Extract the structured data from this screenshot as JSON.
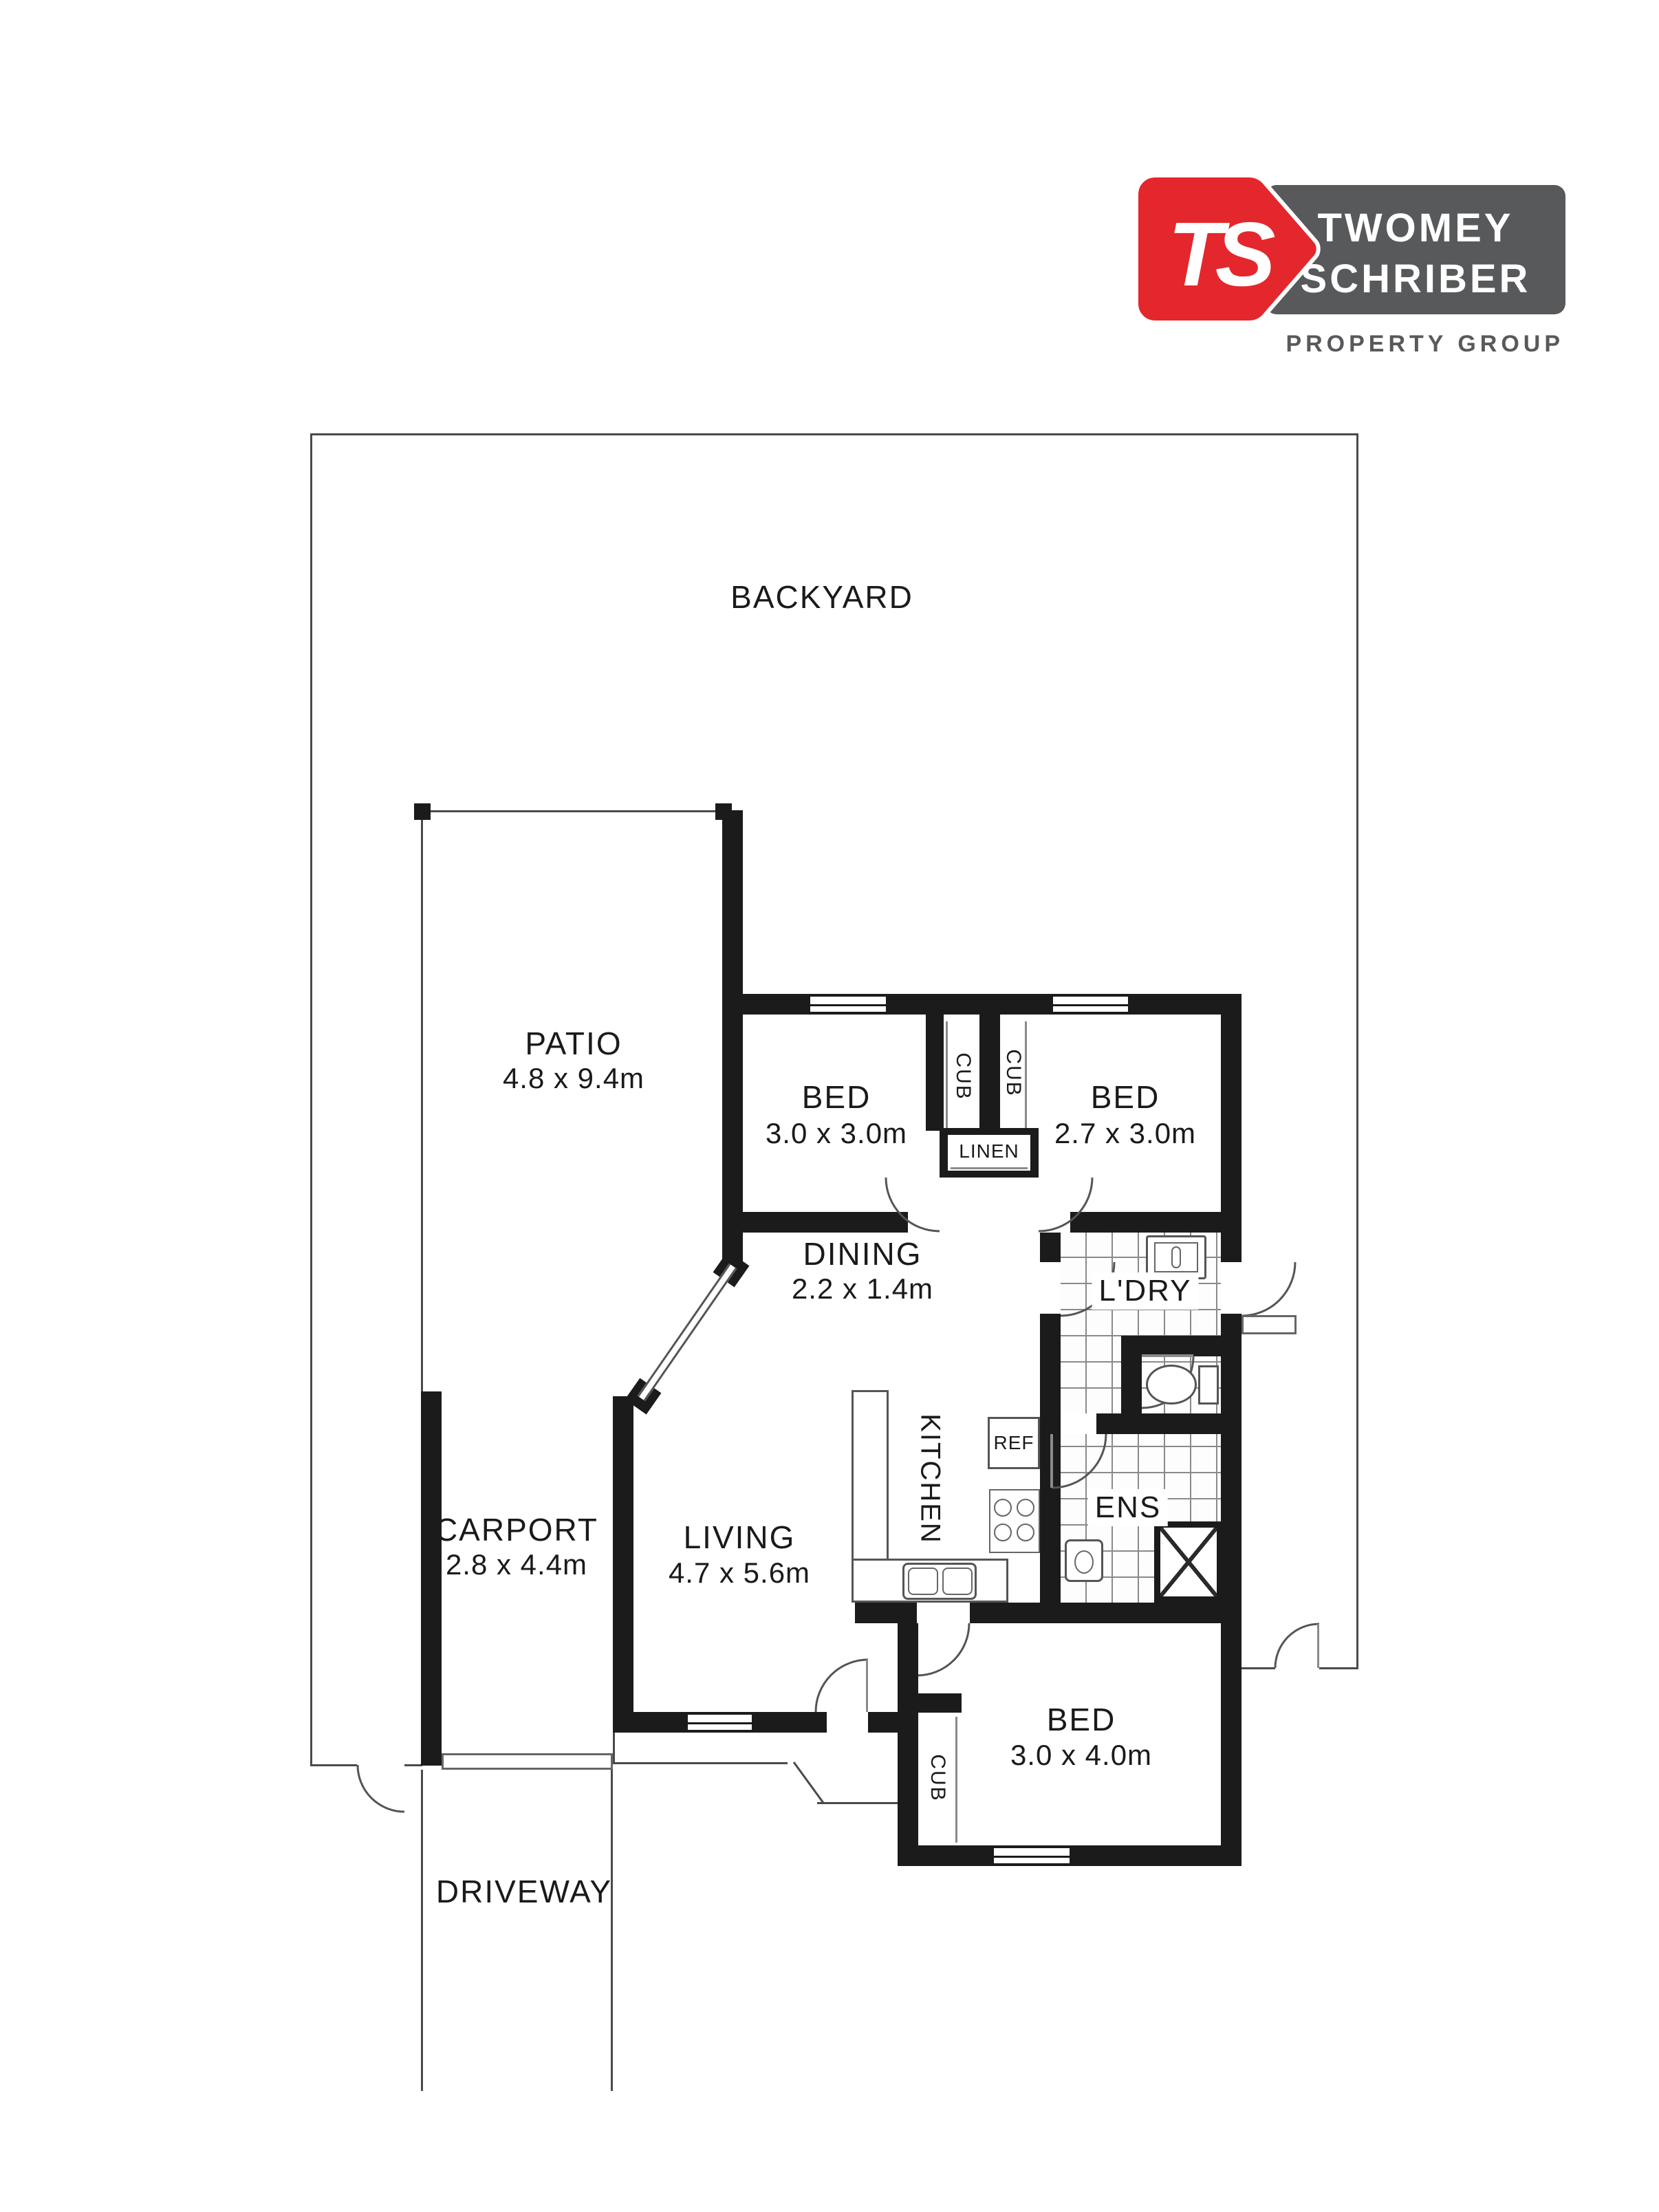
{
  "logo": {
    "monogram": "TS",
    "name_line1": "TWOMEY",
    "name_line2": "SCHRIBER",
    "tagline": "PROPERTY GROUP",
    "colors": {
      "red": "#e4272c",
      "gray": "#58595b",
      "white": "#ffffff"
    }
  },
  "plan": {
    "outdoor": {
      "backyard": {
        "name": "BACKYARD"
      },
      "patio": {
        "name": "PATIO",
        "dims": "4.8 x 9.4m"
      },
      "carport": {
        "name": "CARPORT",
        "dims": "2.8 x 4.4m"
      },
      "driveway": {
        "name": "DRIVEWAY"
      }
    },
    "rooms": {
      "bed1": {
        "name": "BED",
        "dims": "3.0 x 3.0m"
      },
      "bed2": {
        "name": "BED",
        "dims": "2.7 x 3.0m"
      },
      "bed3": {
        "name": "BED",
        "dims": "3.0 x 4.0m"
      },
      "living": {
        "name": "LIVING",
        "dims": "4.7 x 5.6m"
      },
      "dining": {
        "name": "DINING",
        "dims": "2.2 x 1.4m"
      },
      "kitchen": {
        "name": "KITCHEN"
      },
      "laundry": {
        "name": "L'DRY"
      },
      "ensuite": {
        "name": "ENS"
      }
    },
    "storage": {
      "linen": {
        "name": "LINEN"
      },
      "cub": {
        "name": "CUB"
      }
    },
    "appliances": {
      "fridge": {
        "name": "REF"
      }
    },
    "wall_color": "#1b1b1b"
  }
}
